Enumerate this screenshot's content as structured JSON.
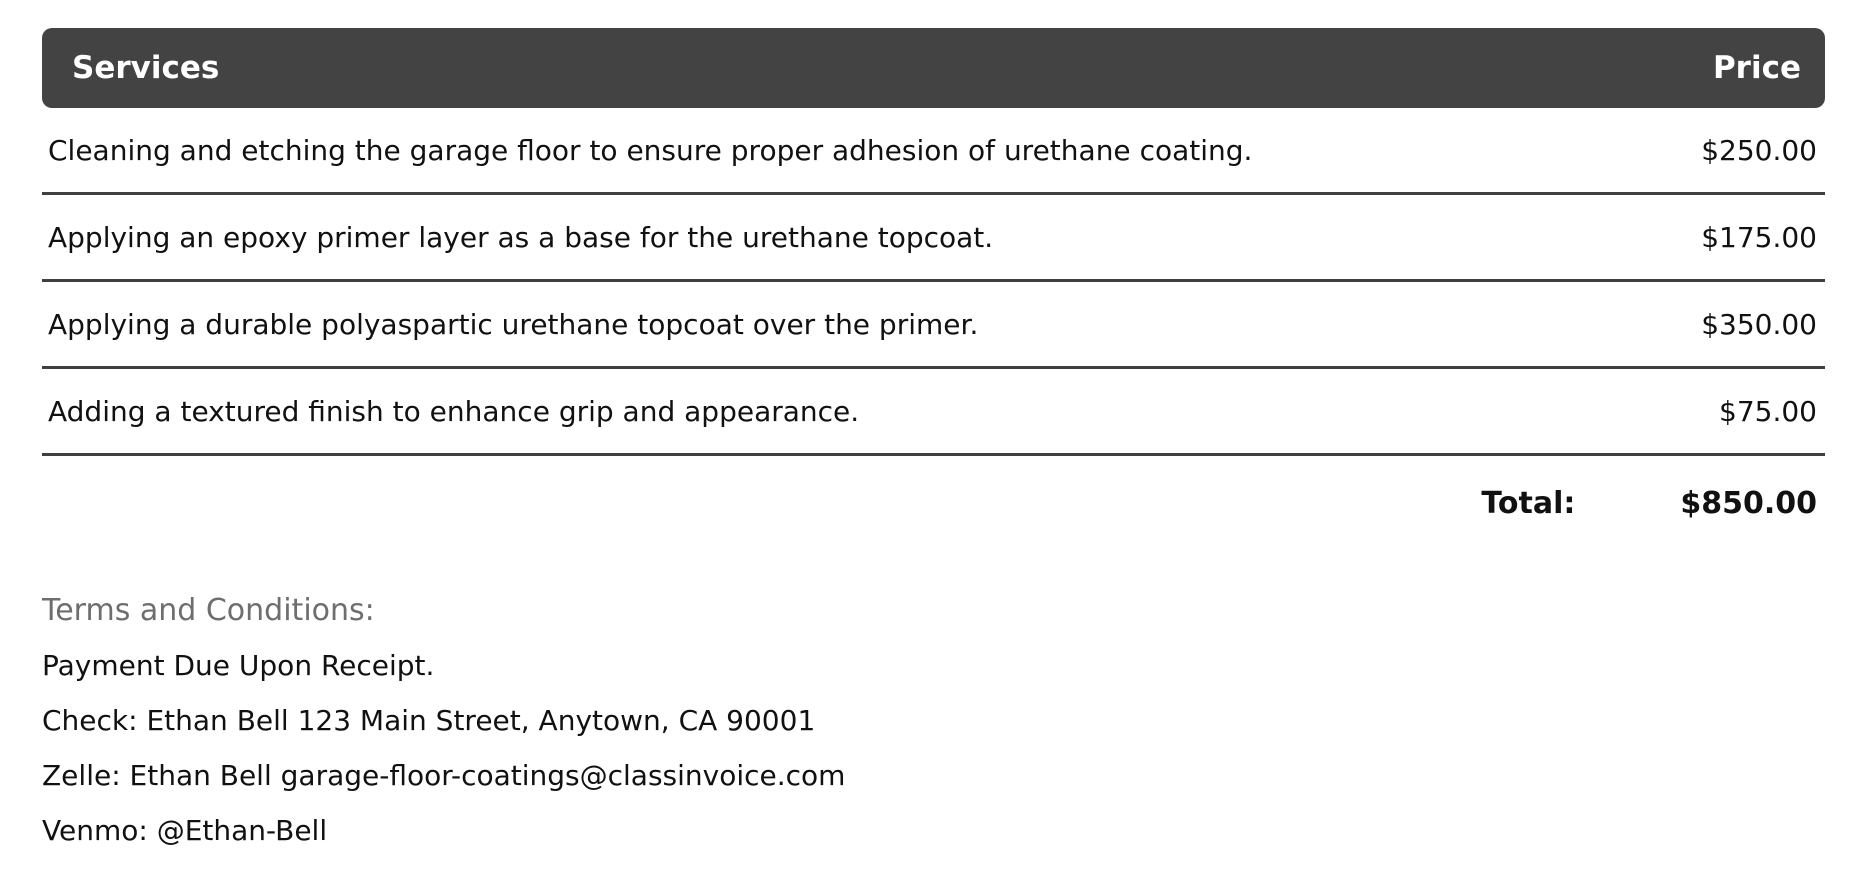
{
  "table": {
    "header": {
      "services_label": "Services",
      "price_label": "Price"
    },
    "rows": [
      {
        "service": "Cleaning and etching the garage floor to ensure proper adhesion of urethane coating.",
        "price": "$250.00"
      },
      {
        "service": "Applying an epoxy primer layer as a base for the urethane topcoat.",
        "price": "$175.00"
      },
      {
        "service": "Applying a durable polyaspartic urethane topcoat over the primer.",
        "price": "$350.00"
      },
      {
        "service": "Adding a textured finish to enhance grip and appearance.",
        "price": "$75.00"
      }
    ],
    "total": {
      "label": "Total:",
      "value": "$850.00"
    }
  },
  "terms": {
    "heading": "Terms and Conditions:",
    "lines": [
      "Payment Due Upon Receipt.",
      "Check: Ethan Bell 123 Main Street, Anytown, CA 90001",
      "Zelle: Ethan Bell garage-floor-coatings@classinvoice.com",
      "Venmo: @Ethan-Bell"
    ]
  },
  "colors": {
    "header_bg": "#434343",
    "header_text": "#ffffff",
    "body_text": "#111111",
    "separator": "#3f3f3f",
    "terms_heading": "#6e6e6e"
  }
}
